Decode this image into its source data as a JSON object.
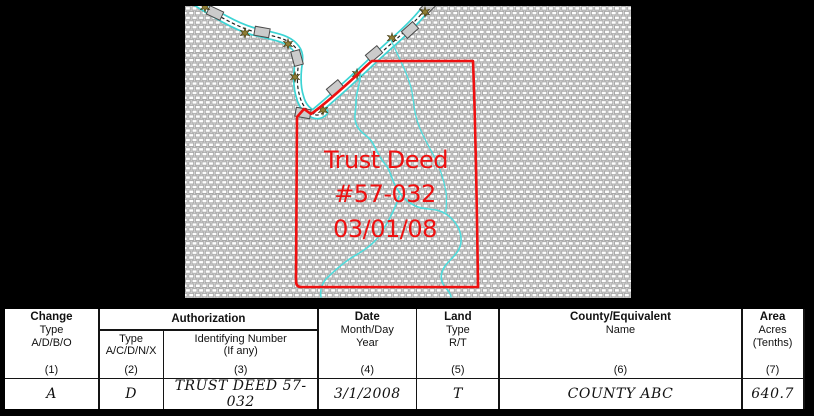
{
  "map": {
    "annotation": {
      "line1": "Trust Deed",
      "line2": "#57-032",
      "line3": "03/01/08"
    },
    "colors": {
      "parcel_boundary": "#ee1010",
      "stream": "#50dcdc",
      "bank_cyan": "#3cd4d4",
      "star_olive": "#8f7d33",
      "tie_gray": "#cbcbcb",
      "hatch_bg": "#dedede"
    },
    "symbols": {
      "star_icon": "six-point-star",
      "tie_icon": "levee-tie"
    }
  },
  "table": {
    "auth_group": "Authorization",
    "headers": {
      "change": {
        "title": "Change",
        "lines": [
          "Type",
          "A/D/B/O"
        ],
        "num": "(1)"
      },
      "auth_type": {
        "lines": [
          "Type",
          "A/C/D/N/X"
        ],
        "num": "(2)"
      },
      "auth_id": {
        "lines": [
          "Identifying Number",
          "(If any)"
        ],
        "num": "(3)"
      },
      "date": {
        "title": "Date",
        "lines": [
          "Month/Day",
          "Year"
        ],
        "num": "(4)"
      },
      "land": {
        "title": "Land",
        "lines": [
          "Type",
          "R/T"
        ],
        "num": "(5)"
      },
      "county": {
        "title": "County/Equivalent",
        "lines": [
          "Name"
        ],
        "num": "(6)"
      },
      "area": {
        "title": "Area",
        "lines": [
          "Acres",
          "(Tenths)"
        ],
        "num": "(7)"
      }
    },
    "row": {
      "change": "A",
      "auth_type": "D",
      "auth_id": "TRUST DEED 57-032",
      "date": "3/1/2008",
      "land": "T",
      "county": "COUNTY ABC",
      "area": "640.7"
    }
  }
}
